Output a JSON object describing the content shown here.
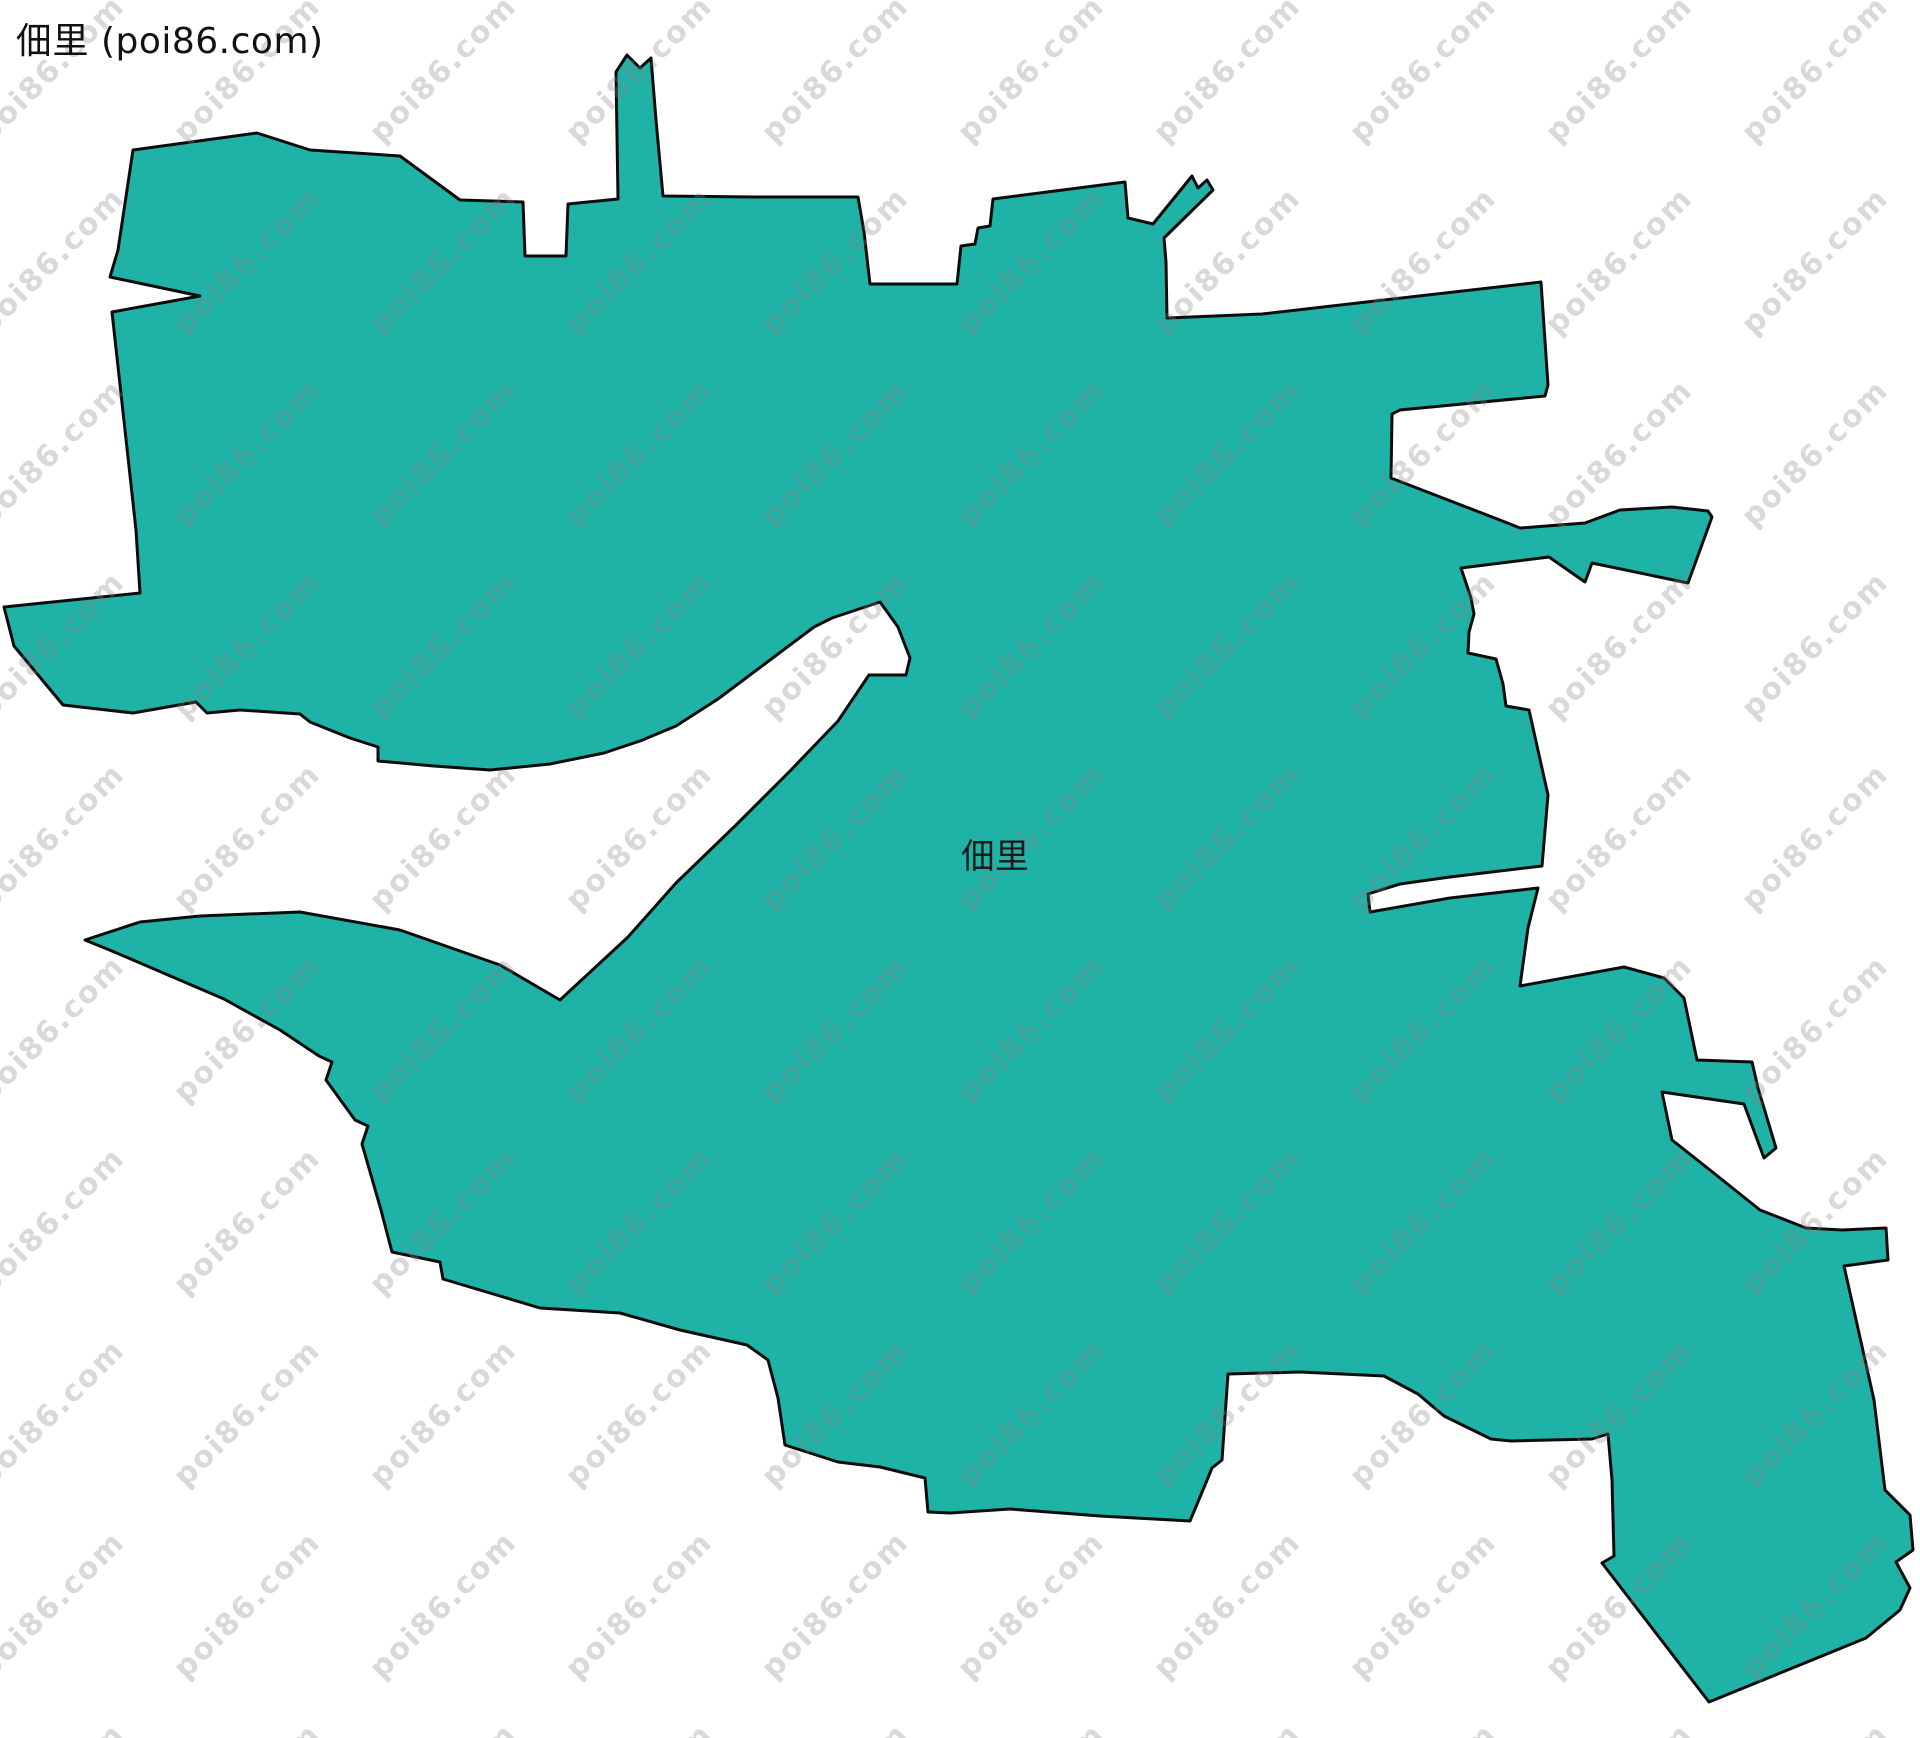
{
  "header": {
    "title": "佃里 (poi86.com)"
  },
  "map": {
    "region_label": "佃里",
    "fill_color": "#1FB3A7",
    "outline_color": "#0b0b0b",
    "outline_width": 3,
    "background_color": "#ffffff",
    "boundary_points": "133,150 257,133 310,150 400,156 460,200 523,202 525,256 566,256 568,204 618,199 616,72 627,55 640,68 651,58 656,120 663,196 755,197 858,197 864,232 870,284 957,284 961,246 975,244 978,228 990,226 993,199 1125,182 1128,218 1153,224 1192,176 1198,188 1207,180 1213,190 1164,238 1166,262 1167,318 1262,314 1541,282 1548,385 1545,396 1400,410 1392,414 1391,478 1505,522 1520,528 1585,523 1620,510 1672,507 1708,511 1712,517 1688,583 1592,563 1585,582 1549,557 1461,568 1471,598 1474,614 1469,632 1468,653 1496,659 1503,684 1506,706 1529,710 1548,795 1542,866 1450,877 1400,884 1368,894 1370,912 1450,898 1538,888 1528,928 1520,986 1624,967 1664,978 1684,998 1697,1060 1752,1062 1758,1088 1776,1148 1764,1158 1744,1104 1662,1092 1672,1140 1710,1170 1760,1210 1806,1228 1842,1230 1886,1228 1888,1260 1844,1266 1874,1400 1885,1490 1910,1515 1913,1550 1896,1562 1910,1588 1900,1610 1866,1638 1709,1702 1602,1563 1614,1556 1612,1480 1608,1434 1592,1439 1511,1441 1491,1439 1444,1416 1418,1394 1384,1376 1300,1372 1228,1374 1222,1460 1212,1468 1205,1485 1190,1521 1100,1516 1010,1509 950,1513 928,1512 925,1478 880,1467 838,1462 785,1445 778,1398 768,1360 747,1345 680,1330 620,1313 540,1308 443,1279 440,1262 392,1252 381,1210 362,1144 368,1126 355,1120 326,1080 332,1062 319,1056 280,1030 224,999 168,975 112,951 85,940 140,922 200,916 300,912 400,930 500,965 560,1000 628,937 676,883 736,825 790,771 838,721 869,675 906,675 910,658 898,627 880,602 832,618 814,627 766,663 718,699 676,726 640,741 604,753 550,764 490,770 434,766 378,761 378,747 350,738 310,722 300,714 240,710 207,713 196,702 133,713 63,705 14,646 4,607 140,593 136,530 125,430 112,312 200,296 110,277 118,250",
    "label_x": "995",
    "label_y": "868"
  },
  "watermark": {
    "text": "poi86.com",
    "color": "#808080",
    "opacity": "0.3"
  }
}
